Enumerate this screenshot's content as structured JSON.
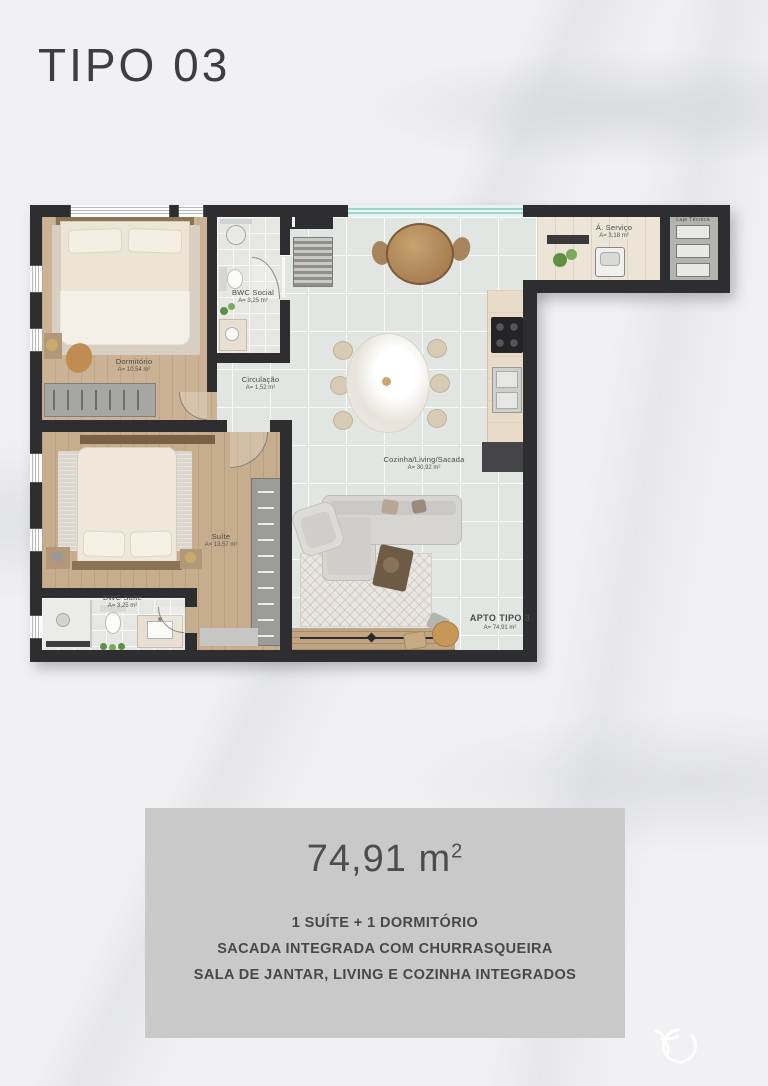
{
  "page": {
    "title": "TIPO 03"
  },
  "plan": {
    "rooms": [
      {
        "label": "Dormitório",
        "area": "A= 10,54 m²"
      },
      {
        "label": "BWC Social",
        "area": "A= 3,25 m²"
      },
      {
        "label": "Circulação",
        "area": "A= 1,52 m²"
      },
      {
        "label": "Cozinha/Living/Sacada",
        "area": "A= 30,92 m²"
      },
      {
        "label": "Á. Serviço",
        "area": "A= 3,18 m²"
      },
      {
        "label": "Laje Técnica",
        "area": ""
      },
      {
        "label": "Suíte",
        "area": "A= 13,57 m²"
      },
      {
        "label": "BWC Suíte",
        "area": "A= 3,25 m²"
      },
      {
        "label": "APTO TIPO 3",
        "area": "A= 74,91 m²"
      }
    ]
  },
  "summary": {
    "area_value": "74,91",
    "area_unit": "m",
    "area_exponent": "2",
    "features": [
      "1 SUÍTE + 1 DORMITÓRIO",
      "SACADA INTEGRADA COM CHURRASQUEIRA",
      "SALA DE JANTAR, LIVING E COZINHA INTEGRADOS"
    ]
  },
  "colors": {
    "wall": "#2e2e30",
    "wood": "#cbb295",
    "tile": "#e2e6e3",
    "glass": "#9fd3cd",
    "panel": "#c9c9ca"
  }
}
